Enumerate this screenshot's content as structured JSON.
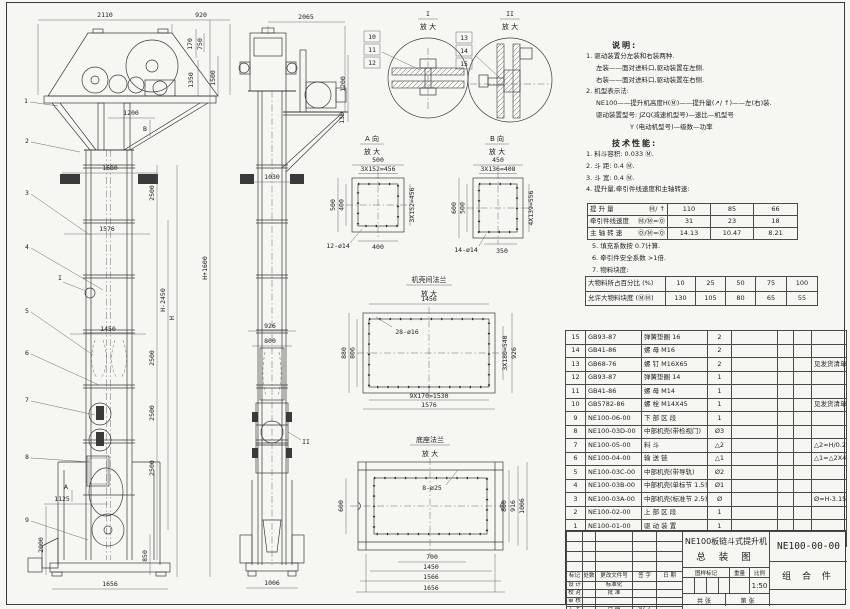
{
  "colors": {
    "paper": "#f6f6f2",
    "line": "#3a3a3a",
    "dim": "#5a5a5a"
  },
  "front": {
    "balloons": [
      "1",
      "2",
      "3",
      "4",
      "5",
      "6",
      "7",
      "8",
      "9"
    ],
    "dims": {
      "d2110": "2110",
      "d920": "920",
      "d170": "170",
      "d750": "750",
      "d1350": "1350",
      "d1500": "1500",
      "d1200": "1200",
      "d1680": "1680",
      "d1576": "1576",
      "d1450": "1450",
      "d1125": "1125",
      "d2000": "2000",
      "d850": "850",
      "d1656": "1656",
      "d2500": "2500",
      "dhp": "H+1600",
      "dhm": "H-2450",
      "dh": "H"
    },
    "markers": {
      "a": "A",
      "b": "B",
      "i": "I"
    }
  },
  "side": {
    "dims": {
      "d2065": "2065",
      "d1200": "1200",
      "d130": "130",
      "d1030": "1030",
      "d926": "926",
      "d800": "800",
      "d1006": "1006"
    },
    "markers": {
      "ii": "II"
    }
  },
  "details": {
    "d1": {
      "title": "I",
      "sub": "放 大",
      "balloons": [
        "10",
        "11",
        "12"
      ]
    },
    "d2": {
      "title": "II",
      "sub": "放 大",
      "balloons": [
        "13",
        "14",
        "15"
      ]
    }
  },
  "view_a": {
    "title": "A 向",
    "sub": "放 大",
    "top1": "500",
    "top2": "3X152=456",
    "left1": "500",
    "left2": "400",
    "right1": "3X152=456",
    "bottom": "400",
    "holes": "12-ø14"
  },
  "view_b": {
    "title": "B 向",
    "sub": "放 大",
    "top1": "450",
    "top2": "3X136=408",
    "left1": "600",
    "left2": "500",
    "right1": "4X139=556",
    "bottom": "350",
    "holes": "14-ø14"
  },
  "flange": {
    "title": "机壳间法兰",
    "sub": "放 大",
    "top": "1456",
    "holes": "28-ø16",
    "left1": "880",
    "left2": "806",
    "right1": "3X180=540",
    "right2": "926",
    "bottom1": "9X170=1530",
    "bottom2": "1576"
  },
  "base": {
    "title": "底座法兰",
    "sub": "放 大",
    "holes": "8-ø25",
    "left1": "600",
    "right1": "800",
    "right2": "916",
    "right3": "1006",
    "bottom1": "700",
    "bottom2": "1450",
    "bottom3": "1566",
    "bottom4": "1656"
  },
  "notes": {
    "heading": "说明:",
    "lines": [
      "1. 驱动装置分左装和右装两种.",
      "左装——面对进料口,驱动装置在左侧.",
      "右装——面对进料口,驱动装置在右侧.",
      "2. 机型表示法:",
      "NE100——提升机高度H(Ⓜ)——提升量(↗/ ↑)——左(右)装.",
      "驱动装置型号: JZQ(减速机型号)—速比—机型号",
      "Y (电动机型号)—级数—功率"
    ]
  },
  "specs": {
    "heading": "技术性能:",
    "lines": [
      "1. 料斗容积: 0.033 Ⓜ.",
      "2. 斗  距: 0.4 Ⓜ.",
      "3. 斗  宽: 0.4 Ⓜ.",
      "4. 提升量,牵引件线速度和主轴转速:"
    ],
    "extra": [
      "5. 填充系数按 0.7计算.",
      "6. 牵引件安全系数 >1倍.",
      "7. 物料块度:"
    ]
  },
  "perf_table": {
    "rows": [
      {
        "label": "提 升 量",
        "unit": "Ⓜ/ ↑",
        "values": [
          "110",
          "85",
          "66"
        ]
      },
      {
        "label": "牵引件线速度",
        "unit": "Ⓜ/Ⓜ=Ⓞ",
        "values": [
          "31",
          "23",
          "18"
        ]
      },
      {
        "label": "主 轴 转 速",
        "unit": "Ⓞ/Ⓜ=Ⓞ",
        "values": [
          "14.13",
          "10.47",
          "8.21"
        ]
      }
    ]
  },
  "size_table": {
    "rows": [
      {
        "label": "大物料所占百分比 (%)",
        "values": [
          "10",
          "25",
          "50",
          "75",
          "100"
        ]
      },
      {
        "label": "允许大物料块度 (ⓂⓂ)",
        "values": [
          "130",
          "105",
          "80",
          "65",
          "55"
        ]
      }
    ]
  },
  "bom": {
    "headers": [
      "序号",
      "代  号",
      "名    称",
      "数量",
      "材  料",
      "单重",
      "总重",
      "备  注"
    ],
    "rows": [
      [
        "15",
        "GB93-87",
        "弹簧垫圈 16",
        "2",
        "",
        "",
        "",
        ""
      ],
      [
        "14",
        "GB41-86",
        "螺 母 M16",
        "2",
        "",
        "",
        "",
        ""
      ],
      [
        "13",
        "GB68-76",
        "螺 钉 M16X65",
        "2",
        "",
        "",
        "",
        "见发货清单"
      ],
      [
        "12",
        "GB93-87",
        "弹簧垫圈 14",
        "1",
        "",
        "",
        "",
        ""
      ],
      [
        "11",
        "GB41-86",
        "螺 母 M14",
        "1",
        "",
        "",
        "",
        ""
      ],
      [
        "10",
        "GB5782-86",
        "螺 栓 M14X45",
        "1",
        "",
        "",
        "",
        "见发货清单"
      ],
      [
        "9",
        "NE100-06-00",
        "下 部 区 段",
        "1",
        "",
        "",
        "",
        ""
      ],
      [
        "8",
        "NE100-03D-00",
        "中部机壳(带检视门)",
        "Ø3",
        "",
        "",
        "",
        ""
      ],
      [
        "7",
        "NE100-05-00",
        "料  斗",
        "△2",
        "",
        "",
        "",
        "△2=H/0.2+5.75"
      ],
      [
        "6",
        "NE100-04-00",
        "输 送 链",
        "△1",
        "",
        "",
        "",
        "△1=△2X4"
      ],
      [
        "5",
        "NE100-03C-00",
        "中部机壳(带导轨)",
        "Ø2",
        "",
        "",
        "",
        ""
      ],
      [
        "4",
        "NE100-03B-00",
        "中部机壳(单标节 1.5Ⓜ,1Ⓜ)",
        "Ø1",
        "",
        "",
        "",
        ""
      ],
      [
        "3",
        "NE100-03A-00",
        "中部机壳(标准节 2.5Ⓜ)",
        "Ø",
        "",
        "",
        "",
        "Ø=H-3.15/2.5"
      ],
      [
        "2",
        "NE100-02-00",
        "上 部 区 段",
        "1",
        "",
        "",
        "",
        ""
      ],
      [
        "1",
        "NE100-01-00",
        "驱 动 装 置",
        "1",
        "",
        "",
        "",
        ""
      ]
    ]
  },
  "titleblock": {
    "rev_headers": [
      "标记",
      "处数",
      "更改文件号",
      "签 字",
      "日 期"
    ],
    "roles": [
      [
        "设 计",
        "标准化"
      ],
      [
        "校 对",
        "批 准"
      ],
      [
        "审 核",
        ""
      ],
      [
        "工 艺",
        "日 期"
      ]
    ],
    "date": "97.7",
    "title1": "NE100板链斗式提升机",
    "title2": "总 装 图",
    "drawing_no": "NE100-00-00",
    "assembly": "组 合 件",
    "mark": "图样标记",
    "weight": "重量",
    "scale_label": "比例",
    "scale": "1:50",
    "sheet_total": "共  张",
    "sheet_no": "第  张"
  }
}
